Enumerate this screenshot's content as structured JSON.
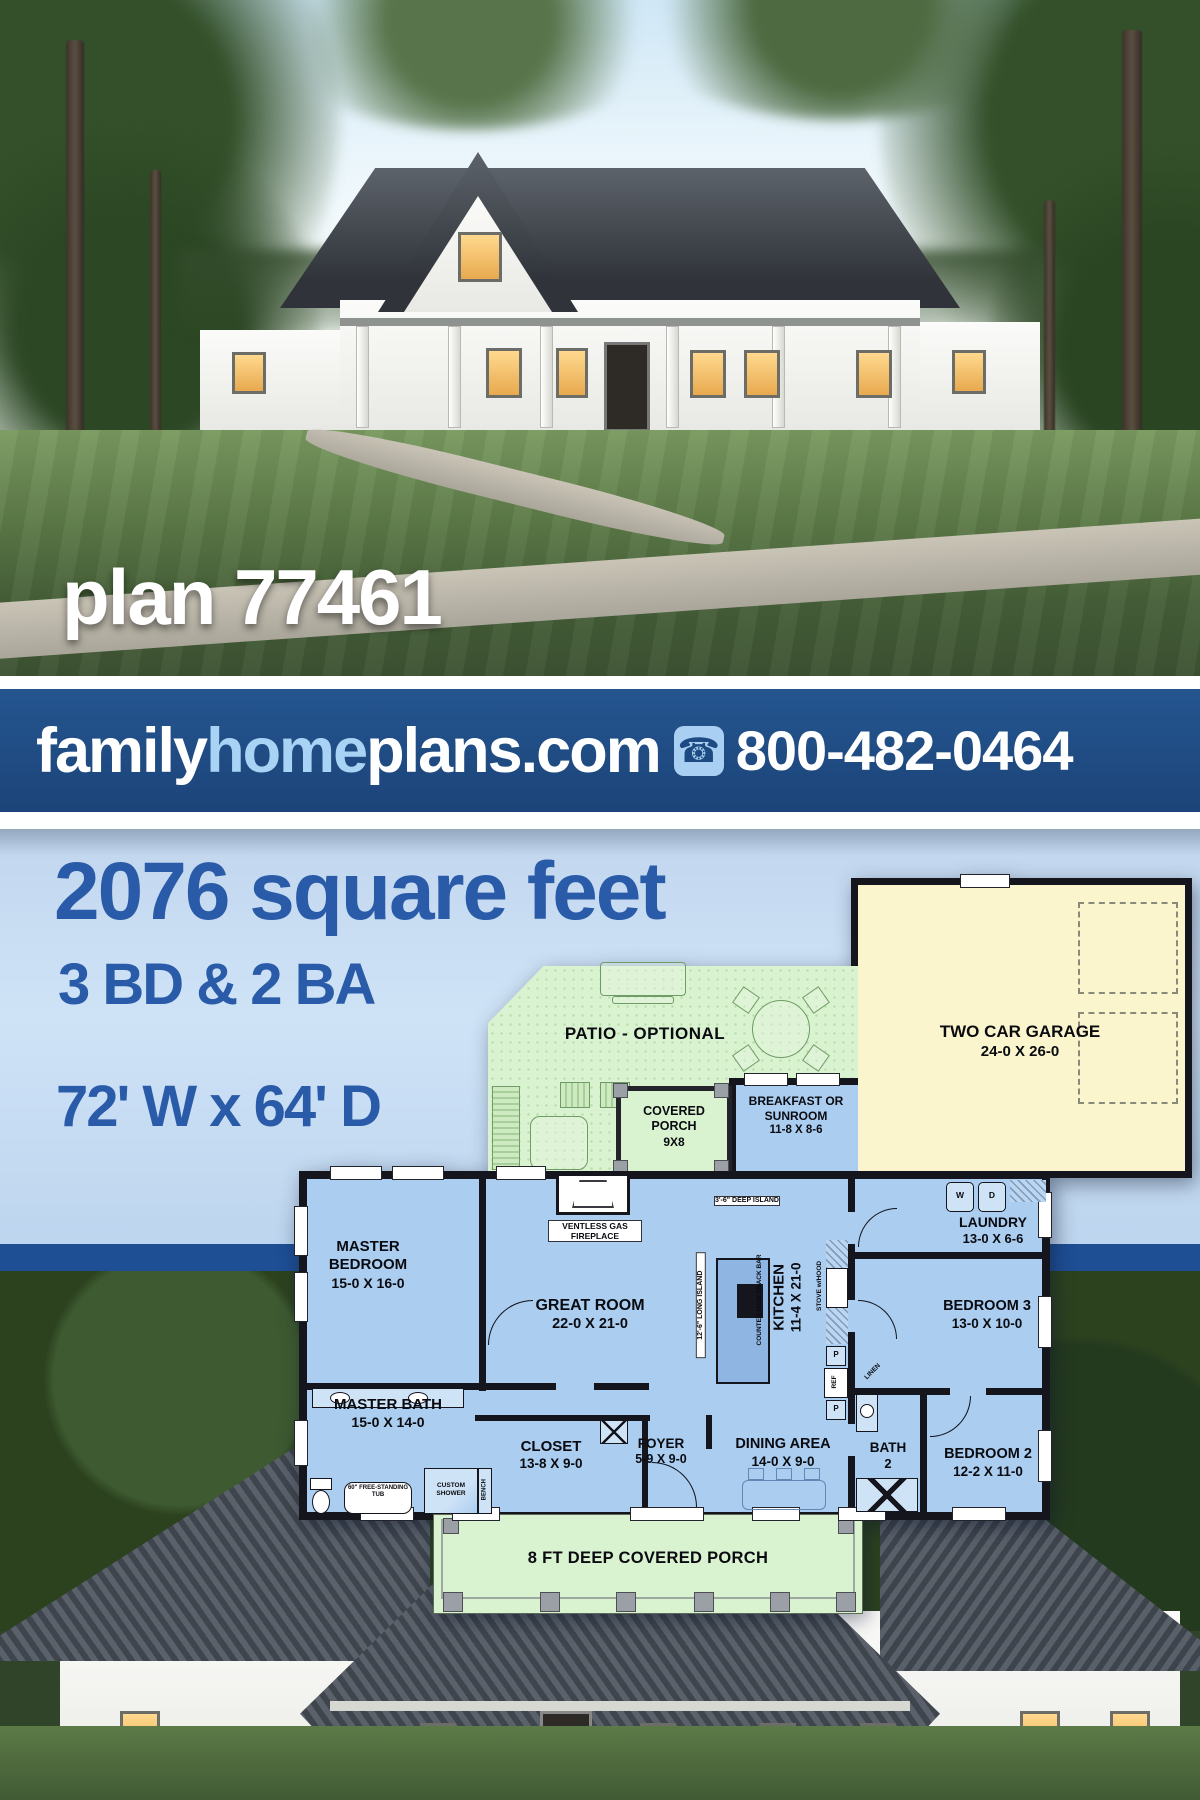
{
  "hero": {
    "plan_label": "plan 77461"
  },
  "banner": {
    "brand": {
      "family": "family",
      "home": "home",
      "plans": "plans",
      "tld": ".com"
    },
    "phone": "800-482-0464",
    "colors": {
      "background": "#1d4a82",
      "accent_light_blue": "#a9d3f5",
      "text": "#ffffff"
    }
  },
  "stats": {
    "square_feet": "2076 square feet",
    "bedrooms_baths": "3 BD & 2 BA",
    "dimensions": "72' W x 64' D"
  },
  "floorplan": {
    "rooms": {
      "patio": {
        "name": "PATIO - OPTIONAL",
        "dims": ""
      },
      "garage": {
        "name": "TWO CAR GARAGE",
        "dims": "24-0 X 26-0"
      },
      "covered_porch": {
        "name": "COVERED PORCH",
        "dims": "9X8"
      },
      "sunroom": {
        "name": "BREAKFAST OR SUNROOM",
        "dims": "11-8 X 8-6"
      },
      "master_bedroom": {
        "name": "MASTER BEDROOM",
        "dims": "15-0 X 16-0"
      },
      "great_room": {
        "name": "GREAT ROOM",
        "dims": "22-0 X 21-0"
      },
      "kitchen": {
        "name": "KITCHEN",
        "dims": "11-4 X 21-0"
      },
      "laundry": {
        "name": "LAUNDRY",
        "dims": "13-0 X 6-6"
      },
      "bedroom3": {
        "name": "BEDROOM 3",
        "dims": "13-0 X 10-0"
      },
      "master_bath": {
        "name": "MASTER BATH",
        "dims": "15-0 X 14-0"
      },
      "closet": {
        "name": "CLOSET",
        "dims": "13-8 X 9-0"
      },
      "foyer": {
        "name": "FOYER",
        "dims": "5-9 X 9-0"
      },
      "dining": {
        "name": "DINING AREA",
        "dims": "14-0 X 9-0"
      },
      "bath2": {
        "name": "BATH",
        "dims": "2"
      },
      "bedroom2": {
        "name": "BEDROOM 2",
        "dims": "12-2 X 11-0"
      },
      "front_porch": {
        "name": "8 FT DEEP COVERED PORCH",
        "dims": ""
      }
    },
    "annotations": {
      "fireplace": "VENTLESS GAS FIREPLACE",
      "island_deep": "3'-6\" DEEP ISLAND",
      "island_long": "12'-6\" LONG ISLAND",
      "snack_bar": "COUNTER HIGH SNACK BAR",
      "stove": "STOVE w/HOOD",
      "ref": "REF",
      "linen": "LINEN",
      "washer": "W",
      "dryer": "D",
      "pantry_upper": "P",
      "pantry_lower": "P",
      "tub": "60\" FREE-STANDING TUB",
      "shower": "CUSTOM SHOWER",
      "bench": "BENCH"
    },
    "colors": {
      "interior": "#aacdf0",
      "garage": "#faf5cc",
      "outdoor_green": "#d9f2cf",
      "island": "#8fb6e2",
      "walls": "#15151d"
    }
  }
}
